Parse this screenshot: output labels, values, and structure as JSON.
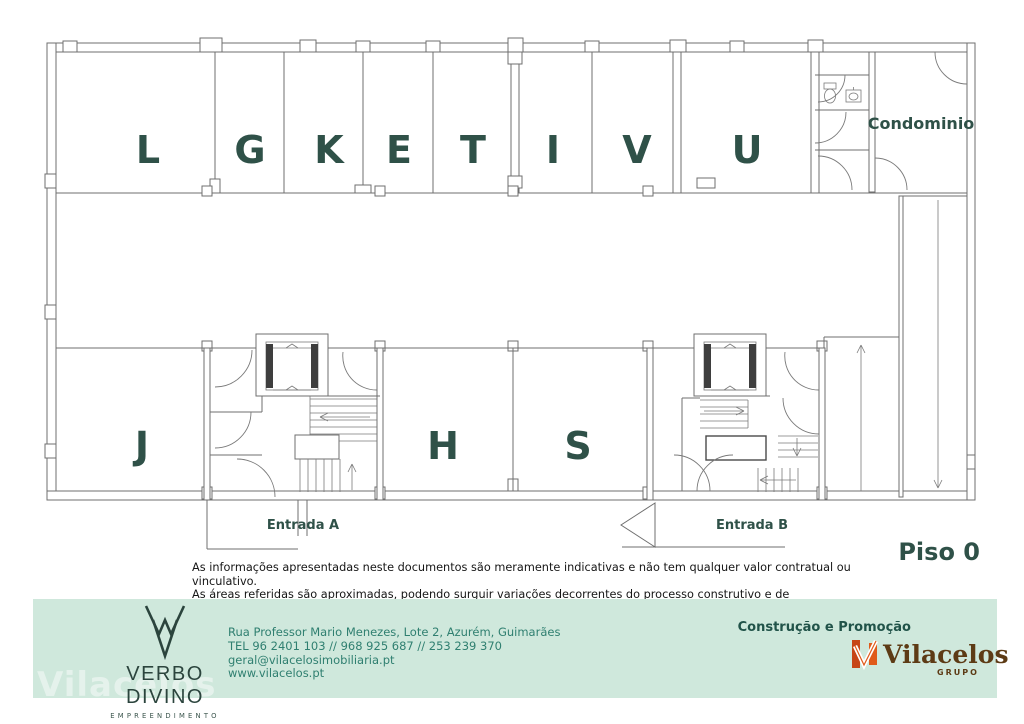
{
  "plan": {
    "floor_label": "Piso 0",
    "units_top": [
      "L",
      "G",
      "K",
      "E",
      "T",
      "I",
      "V",
      "U"
    ],
    "units_bottom": [
      "J",
      "H",
      "S"
    ],
    "condominium_label": "Condominio",
    "entrance_a_label": "Entrada A",
    "entrance_b_label": "Entrada B"
  },
  "disclaimer": {
    "line1": "As informações apresentadas neste documentos são meramente indicativas e não tem qualquer valor contratual ou vinculativo.",
    "line2": "As áreas referidas são aproximadas, podendo surguir variações decorrentes do processo construtivo e de licenciamento"
  },
  "footer": {
    "developer_name": "VERBO DIVINO",
    "developer_subtitle": "EMPREENDIMENTO",
    "address": "Rua Professor Mario Menezes, Lote 2, Azurém, Guimarães",
    "phone": "TEL 96 2401 103 // 968 925 687 // 253 239 370",
    "email": "geral@vilacelosimobiliaria.pt",
    "website": "www.vilacelos.pt",
    "promoter_heading": "Construção e Promoção",
    "brand_name": "Vilacelos",
    "brand_subtitle": "GRUPO",
    "watermark": "Vilacelos"
  },
  "colors": {
    "label_teal": "#2f5148",
    "contact_teal": "#2f7f70",
    "band_mint": "#cfe8dc",
    "brand_orange": "#d0491c",
    "brand_brown": "#5d3b15",
    "line_gray": "#6f6f6f"
  }
}
